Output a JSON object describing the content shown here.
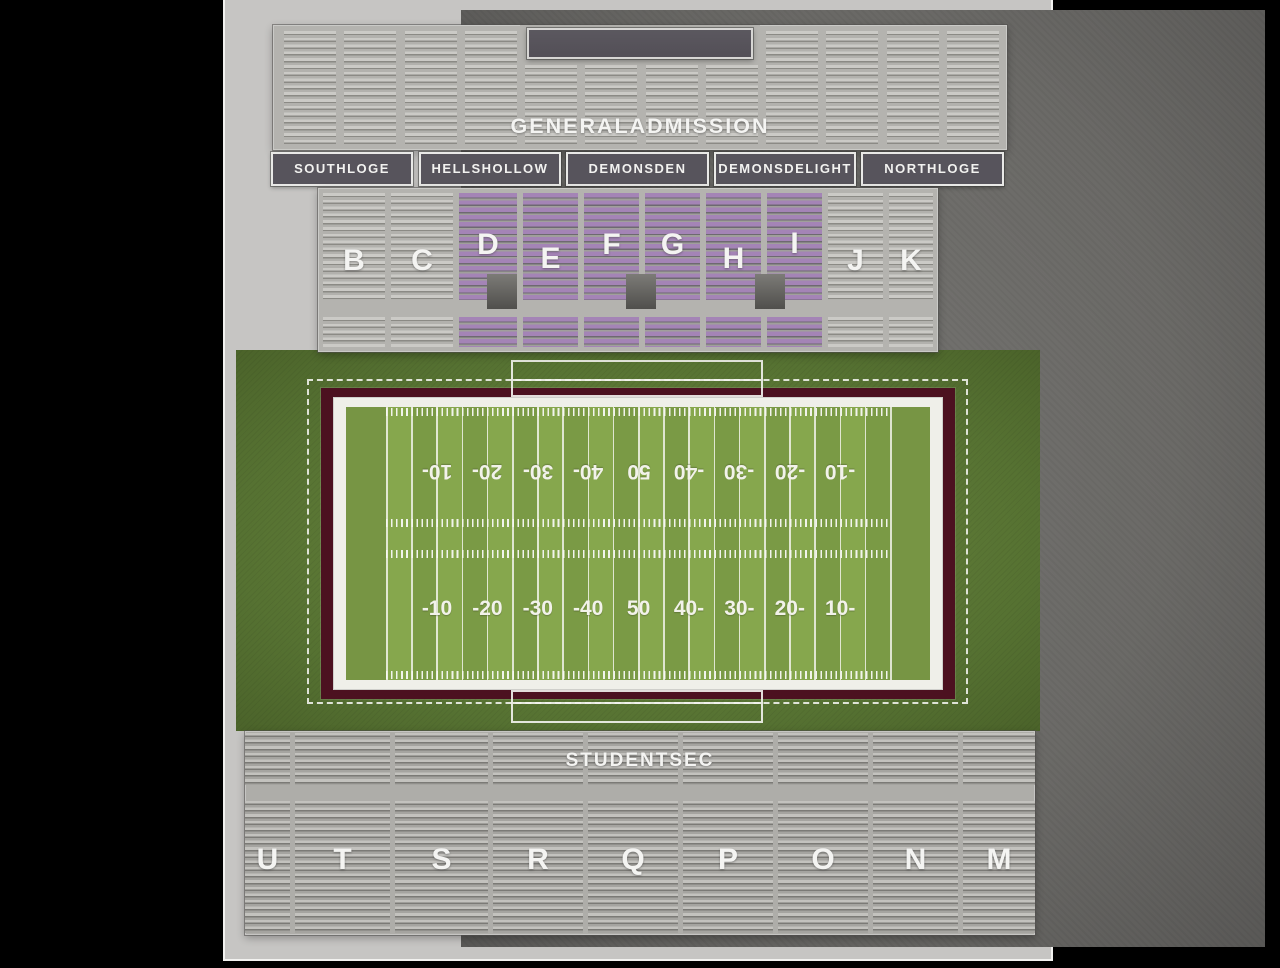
{
  "venue_map": {
    "general_admission": {
      "label": "GENERALADMISSION"
    },
    "loges": {
      "labels": [
        "SOUTHLOGE",
        "HELLSHOLLOW",
        "DEMONSDEN",
        "DEMONSDELIGHT",
        "NORTHLOGE"
      ]
    },
    "reserved_sections": {
      "labels": [
        "B",
        "C",
        "D",
        "E",
        "F",
        "G",
        "H",
        "I",
        "J",
        "K"
      ],
      "highlighted": [
        "D",
        "E",
        "F",
        "G",
        "H",
        "I"
      ]
    },
    "student_section": {
      "label": "STUDENTSEC",
      "section_labels": [
        "U",
        "T",
        "S",
        "R",
        "Q",
        "P",
        "O",
        "N",
        "M"
      ]
    },
    "field": {
      "yard_numbers_bottom": [
        "-10",
        "-20",
        "-30",
        "-40",
        "50",
        "40-",
        "30-",
        "20-",
        "10-"
      ],
      "yard_numbers_top": [
        "10-",
        "20-",
        "30-",
        "40-",
        "50",
        "-40",
        "-30",
        "-20",
        "-10"
      ]
    },
    "colors": {
      "highlight_purple": "#9f80b2",
      "field_green": "#7d9e47",
      "apron_green": "#5a7834",
      "maroon": "#4c1120",
      "stand_gray": "#b4b3af",
      "label_box_gray": "#56535b"
    }
  }
}
